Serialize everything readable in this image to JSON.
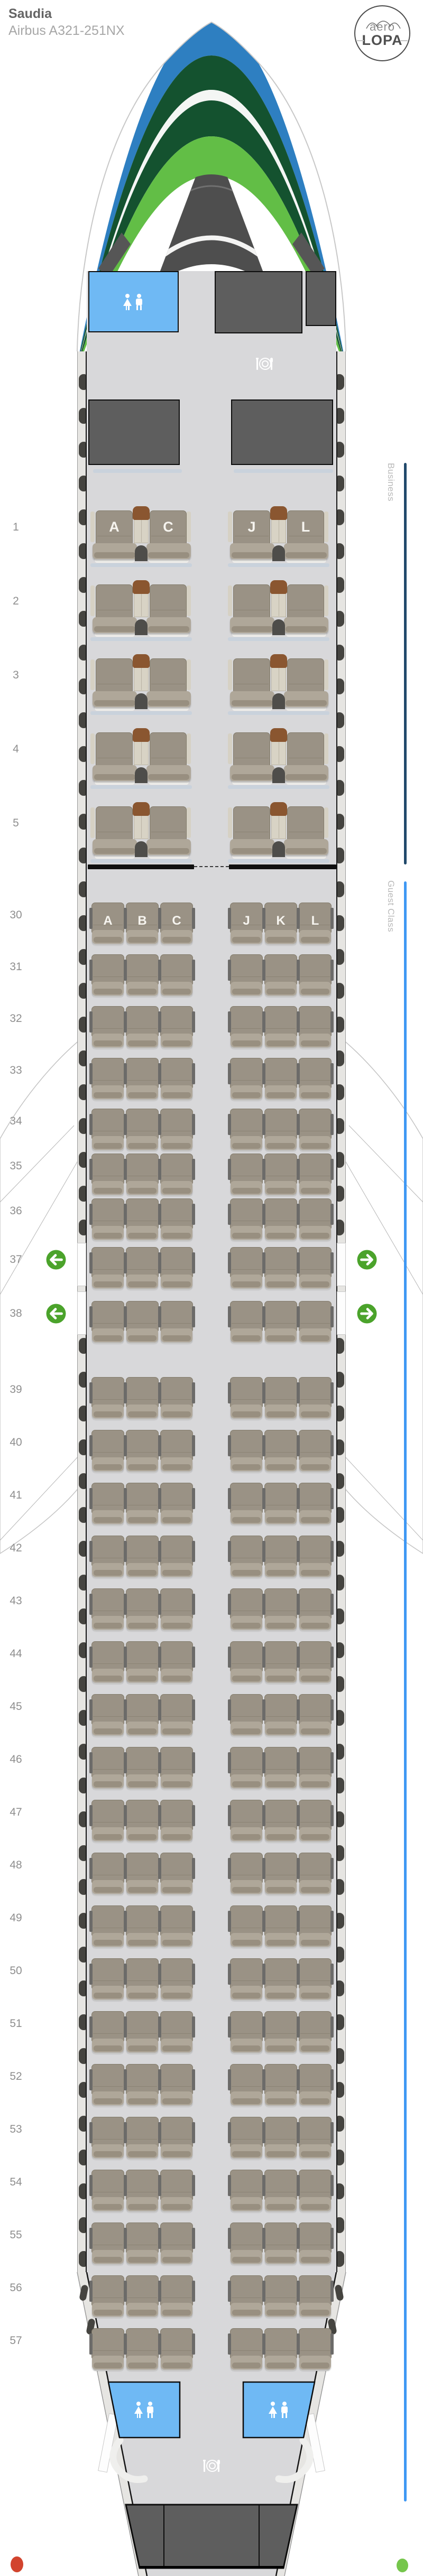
{
  "header": {
    "airline": "Saudia",
    "aircraft": "Airbus A321-251NX"
  },
  "logo": {
    "top": "aero",
    "bottom": "LOPA"
  },
  "sections": [
    {
      "id": "business",
      "label": "Business",
      "line_color": "#21496B",
      "seat_letters": [
        "A",
        "C",
        "J",
        "L"
      ],
      "rows": [
        1,
        2,
        3,
        4,
        5
      ]
    },
    {
      "id": "guest",
      "label": "Guest Class",
      "line_color": "#3F98F4",
      "seat_letters": [
        "A",
        "B",
        "C",
        "J",
        "K",
        "L"
      ],
      "rows": [
        30,
        31,
        32,
        33,
        34,
        35,
        36,
        37,
        38,
        39,
        40,
        41,
        42,
        43,
        44,
        45,
        46,
        47,
        48,
        49,
        50,
        51,
        52,
        53,
        54,
        55,
        56,
        57
      ]
    }
  ],
  "exit_rows": [
    37,
    38
  ],
  "monuments": {
    "front": [
      {
        "id": "front-lavatory",
        "type": "lavatory",
        "icon": "male-female-icon"
      },
      {
        "id": "front-galley-right",
        "type": "galley"
      },
      {
        "id": "front-galley-right-side",
        "type": "galley"
      },
      {
        "id": "mid-galley-left",
        "type": "galley"
      },
      {
        "id": "mid-galley-right",
        "type": "galley"
      }
    ],
    "rear": [
      {
        "id": "rear-lavatory-left",
        "type": "lavatory",
        "icon": "male-female-icon"
      },
      {
        "id": "rear-lavatory-right",
        "type": "lavatory",
        "icon": "male-female-icon"
      },
      {
        "id": "rear-galley",
        "type": "galley"
      }
    ],
    "galley_service_icon": "plate-cutlery-icon"
  },
  "legend": {
    "left_dot_color": "#D2442E",
    "right_dot_color": "#76C64C"
  },
  "colors": {
    "seat_back": "#9A9285",
    "seat_cushion": "#AFA799",
    "lavatory": "#6FB9F4",
    "galley": "#5E5E5E",
    "exit_green": "#4BA32B",
    "window": "#454440",
    "fuselage_wall": "#E6E5E2",
    "cabin_floor": "#D8D8DA",
    "console_brown": "#8A5630",
    "line_business": "#21496B",
    "line_guest": "#3F98F4",
    "livery_blue": "#2E7FC1",
    "livery_dark_green": "#14522F",
    "livery_light_green": "#62BE46"
  }
}
